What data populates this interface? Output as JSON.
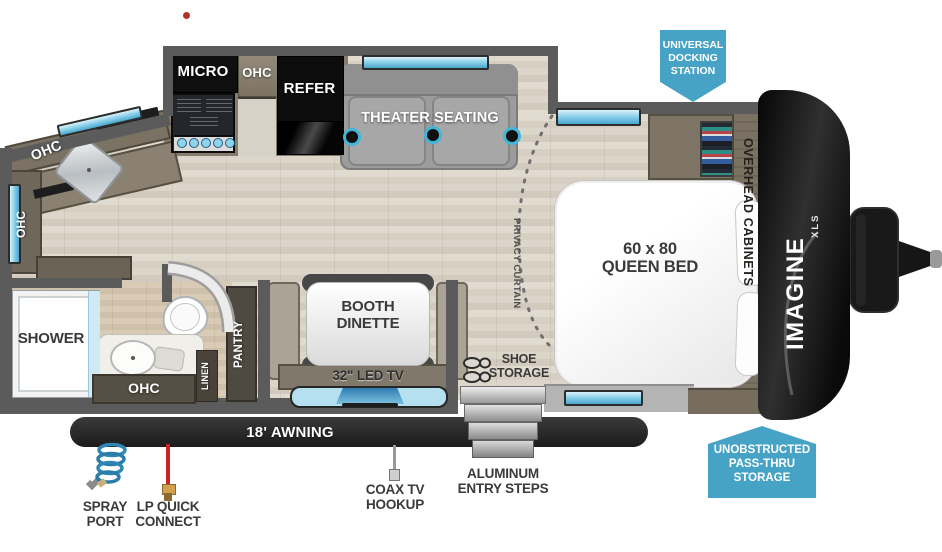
{
  "kitchen": {
    "micro": "MICRO",
    "ohc_upper": "OHC",
    "refer": "REFER",
    "ohc_corner": "OHC",
    "ohc_left": "OHC"
  },
  "living": {
    "theater_seating": "THEATER SEATING"
  },
  "bedroom": {
    "bed_size": "60 x 80",
    "bed_type": "QUEEN BED",
    "overhead_cabinets": "OVERHEAD CABINETS",
    "privacy_curtain": "PRIVACY CURTAIN",
    "shoe_line1": "SHOE",
    "shoe_line2": "STORAGE"
  },
  "dinette": {
    "line1": "BOOTH",
    "line2": "DINETTE",
    "tv": "32\" LED TV",
    "pantry": "PANTRY"
  },
  "bath": {
    "shower": "SHOWER",
    "ohc": "OHC",
    "linen": "LINEN"
  },
  "exterior": {
    "awning": "18' AWNING",
    "spray_line1": "SPRAY",
    "spray_line2": "PORT",
    "lp_line1": "LP QUICK",
    "lp_line2": "CONNECT",
    "coax_line1": "COAX TV",
    "coax_line2": "HOOKUP",
    "steps_line1": "ALUMINUM",
    "steps_line2": "ENTRY STEPS"
  },
  "callouts": {
    "docking": [
      "UNIVERSAL",
      "DOCKING",
      "STATION"
    ],
    "passthru": [
      "UNOBSTRUCTED",
      "PASS-THRU",
      "STORAGE"
    ]
  },
  "brand": {
    "name": "IMAGINE",
    "sub": "XLS"
  },
  "colors": {
    "callout_blue": "#47a3c6",
    "wall_gray": "#5b5b5b",
    "window_cyan": "#8ed2ea",
    "awning_black": "#262626",
    "accent_red": "#b63029"
  }
}
